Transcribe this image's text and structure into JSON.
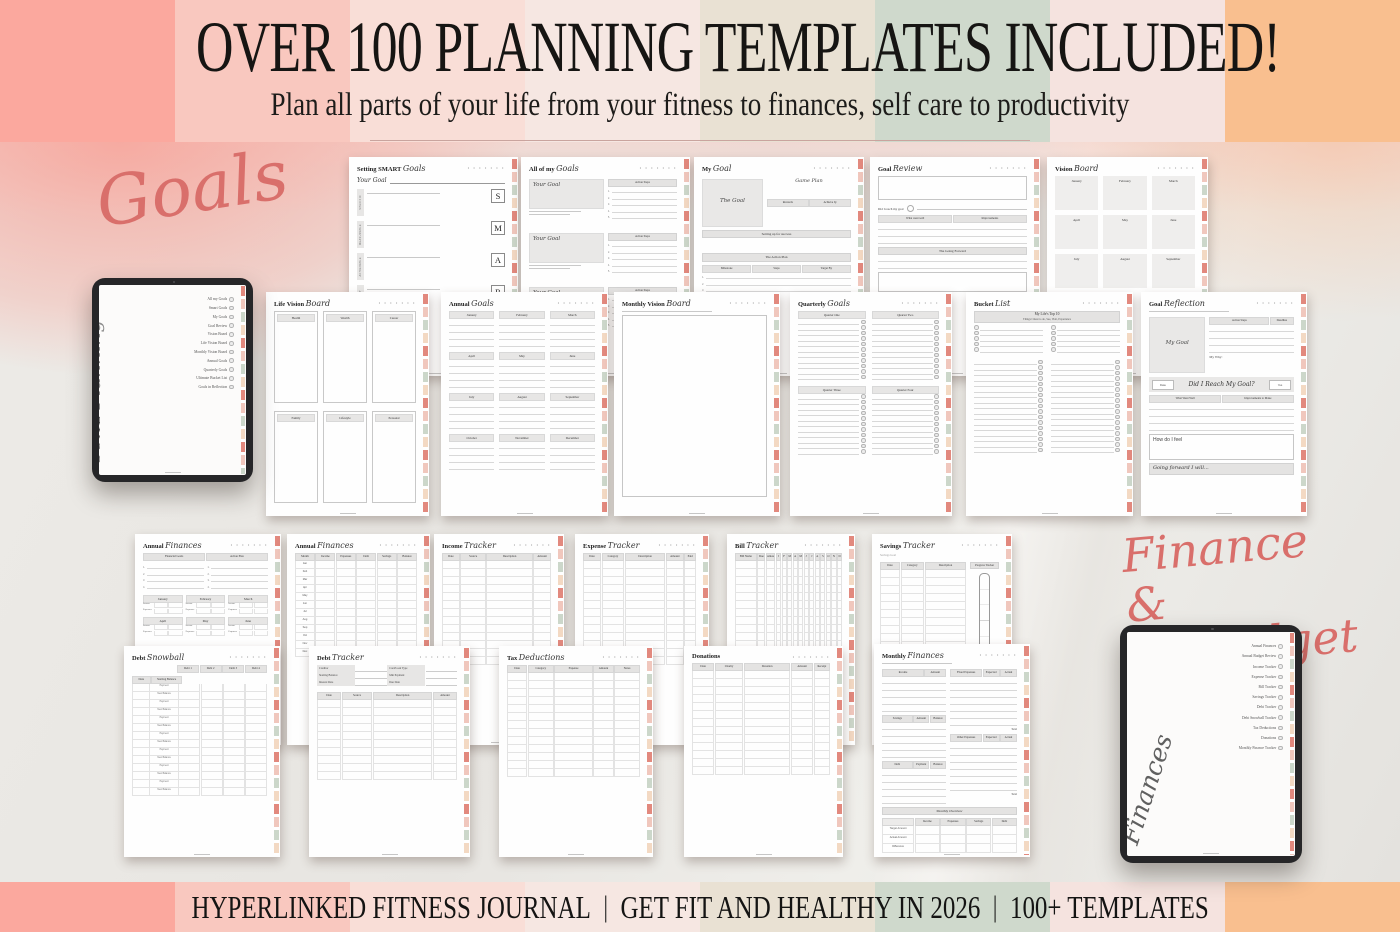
{
  "header": {
    "title": "OVER 100 PLANNING TEMPLATES INCLUDED!",
    "subtitle": "Plan all parts of your life from your fitness to finances, self care to productivity"
  },
  "footer": {
    "part1": "HYPERLINKED FITNESS JOURNAL",
    "part2": "GET FIT AND HEALTHY IN 2026",
    "part3": "100+ TEMPLATES",
    "separator": "|"
  },
  "section_labels": {
    "goals": "Goals",
    "finance_line1": "Finance &",
    "finance_line2": "Budget"
  },
  "colors": {
    "accent_script": "#d96f6b",
    "stripes": [
      "#fba89e",
      "#f9c8bf",
      "#f9ded7",
      "#f6e7e2",
      "#e9e1d3",
      "#cfd9cc",
      "#f5e3df",
      "#f9bf8f"
    ],
    "tab_colors": [
      "#e2897e",
      "#f0c7bd",
      "#ccd7ca",
      "#f3d9c3"
    ]
  },
  "page_chrome": {
    "dots": "• • • • • • •"
  },
  "tablets": {
    "left": {
      "label_serif": "GOAL",
      "label_script": "Planning",
      "items": [
        "All my Goals",
        "Smart Goals",
        "My Goals",
        "Goal Review",
        "Vision Board",
        "Life Vision Board",
        "Monthly Vision Board",
        "Annual Goals",
        "Quarterly Goals",
        "Ultimate Bucket List",
        "Goals in Reflection"
      ]
    },
    "right": {
      "label_script": "Finances",
      "items": [
        "Annual Finances",
        "Annual Budget Review",
        "Income Tracker",
        "Expense Tracker",
        "Bill Tracker",
        "Savings Tracker",
        "Debt Tracker",
        "Debt Snowball Tracker",
        "Tax Deductions",
        "Donations",
        "Monthly Finance Tracker"
      ]
    }
  },
  "pages": [
    {
      "id": "setting-smart-goals",
      "title_main": "Setting SMART",
      "title_script": "Goals",
      "body": [
        {
          "t": "field",
          "label": "Your Goal"
        },
        {
          "t": "smart",
          "rows": [
            [
              "S",
              "Specific"
            ],
            [
              "M",
              "Measurable"
            ],
            [
              "A",
              "Achievable"
            ],
            [
              "R",
              "Relevant"
            ]
          ]
        }
      ]
    },
    {
      "id": "all-of-my-goals",
      "title_main": "All of my",
      "title_script": "Goals",
      "body": [
        {
          "t": "goalblock",
          "box_label": "Your Goal",
          "steps_label": "Action Steps",
          "n": 5
        },
        {
          "t": "gap",
          "h": 8
        },
        {
          "t": "goalblock",
          "box_label": "Your Goal",
          "steps_label": "Action Steps",
          "n": 5
        },
        {
          "t": "gap",
          "h": 8
        },
        {
          "t": "goalblock",
          "box_label": "Your Goal",
          "steps_label": "Action Steps",
          "n": 5
        }
      ]
    },
    {
      "id": "my-goal",
      "title_main": "My",
      "title_script": "Goal",
      "body": [
        {
          "t": "split",
          "l": 42,
          "r": 58,
          "left": [
            {
              "t": "box",
              "h": 48,
              "mode": "fill",
              "label": "The Goal",
              "script": true
            }
          ],
          "right": [
            {
              "t": "text",
              "text": "Game Plan",
              "script": true,
              "align": "center",
              "size": 5
            },
            {
              "t": "gap",
              "h": 12
            },
            {
              "t": "cols",
              "cells": [
                {
                  "text": "Rewards"
                },
                {
                  "text": "Achieve by"
                }
              ]
            }
          ]
        },
        {
          "t": "band",
          "text": "Setting up for success"
        },
        {
          "t": "gap",
          "h": 12
        },
        {
          "t": "band",
          "text": "The Action Plan"
        },
        {
          "t": "cols",
          "cells": [
            {
              "text": "Milestone"
            },
            {
              "text": "Steps"
            },
            {
              "text": "Target By"
            }
          ]
        },
        {
          "t": "numlines",
          "n": 3
        }
      ]
    },
    {
      "id": "goal-review",
      "title_main": "Goal",
      "title_script": "Review",
      "body": [
        {
          "t": "box",
          "h": 24,
          "mode": "outline"
        },
        {
          "t": "reviewrow",
          "label": "Did I reach my goal"
        },
        {
          "t": "cols",
          "cells": [
            {
              "text": "What went well"
            },
            {
              "text": "Improvements"
            }
          ]
        },
        {
          "t": "rule",
          "n": 3
        },
        {
          "t": "band",
          "text": "The Going Forward"
        },
        {
          "t": "rule",
          "n": 2
        },
        {
          "t": "box",
          "h": 20,
          "mode": "outline"
        }
      ]
    },
    {
      "id": "vision-board",
      "title_main": "Vision",
      "title_script": "Board",
      "body": [
        {
          "t": "grid",
          "mode": "fill",
          "cols": 3,
          "cellH": 34,
          "gap": 5,
          "labels": [
            "January",
            "February",
            "March",
            "April",
            "May",
            "June",
            "July",
            "August",
            "September"
          ]
        }
      ]
    },
    {
      "id": "life-vision-board",
      "title_main": "Life Vision",
      "title_script": "Board",
      "body": [
        {
          "t": "grid",
          "mode": "outline",
          "cols": 3,
          "cellH": 92,
          "gap": 5,
          "labels": [
            "Health",
            "Wealth",
            "Career"
          ]
        },
        {
          "t": "gap",
          "h": 5
        },
        {
          "t": "grid",
          "mode": "outline",
          "cols": 3,
          "cellH": 92,
          "gap": 5,
          "labels": [
            "Family",
            "Lifestyle",
            "Personal"
          ]
        }
      ]
    },
    {
      "id": "annual-goals",
      "title_main": "Annual",
      "title_script": "Goals",
      "body": [
        {
          "t": "grid",
          "mode": "bandlines",
          "cols": 3,
          "gap": 5,
          "lines": 4,
          "labels": [
            "January",
            "February",
            "March",
            "April",
            "May",
            "June",
            "July",
            "August",
            "September",
            "October",
            "November",
            "December"
          ]
        }
      ]
    },
    {
      "id": "monthly-vision-board",
      "title_main": "Monthly Vision",
      "title_script": "Board",
      "body": [
        {
          "t": "blurb",
          "w": 62
        },
        {
          "t": "box",
          "h": 182,
          "mode": "outline"
        }
      ]
    },
    {
      "id": "quarterly-goals",
      "title_main": "Quarterly",
      "title_script": "Goals",
      "body": [
        {
          "t": "grid",
          "mode": "quarter",
          "cols": 2,
          "gap": 6,
          "lines": 11,
          "labels": [
            "Quarter One",
            "Quarter Two",
            "Quarter Three",
            "Quarter Four"
          ]
        }
      ]
    },
    {
      "id": "bucket-list",
      "title_main": "Bucket",
      "title_script": "List",
      "body": [
        {
          "t": "band2",
          "l1": "My Life's Top 10",
          "l2": "Things I must to do, See, Visit, Experience"
        },
        {
          "t": "checklist",
          "colsn": 2,
          "n": 5,
          "side": "left"
        },
        {
          "t": "gap",
          "h": 5
        },
        {
          "t": "checklist",
          "colsn": 2,
          "n": 17,
          "side": "right"
        }
      ]
    },
    {
      "id": "goal-reflection",
      "title_main": "Goal",
      "title_script": "Reflection",
      "body": [
        {
          "t": "blurb",
          "w": 55
        },
        {
          "t": "split",
          "l": 40,
          "r": 60,
          "left": [
            {
              "t": "box",
              "h": 56,
              "mode": "fill",
              "label": "My Goal",
              "script": true
            }
          ],
          "right": [
            {
              "t": "cols",
              "cells": [
                {
                  "text": "Action Steps",
                  "w": 2.6
                },
                {
                  "text": "Deadline",
                  "w": 1
                }
              ]
            },
            {
              "t": "rule",
              "n": 4
            },
            {
              "t": "text",
              "text": "My Why:",
              "size": 3.4
            }
          ]
        },
        {
          "t": "reviewband",
          "left": "Date",
          "script": "Did I Reach My Goal?",
          "right": "Yes"
        },
        {
          "t": "cols",
          "cells": [
            {
              "text": "What Went Well"
            },
            {
              "text": "Improvements to Make"
            }
          ]
        },
        {
          "t": "rule",
          "n": 4
        },
        {
          "t": "box",
          "h": 26,
          "mode": "outline",
          "label": "How do I feel",
          "labelPos": "tl"
        },
        {
          "t": "band",
          "text": "Going forward I will...",
          "script": true,
          "align": "left",
          "h": 12
        }
      ]
    },
    {
      "id": "annual-finances-overview",
      "title_main": "Annual",
      "title_script": "Finances",
      "body": [
        {
          "t": "cols",
          "cells": [
            {
              "text": "Financial Goals"
            },
            {
              "text": "Action Plan"
            }
          ]
        },
        {
          "t": "split",
          "l": 50,
          "r": 50,
          "left": [
            {
              "t": "numlines",
              "n": 4
            }
          ],
          "right": [
            {
              "t": "numlines",
              "n": 4
            }
          ]
        },
        {
          "t": "gap",
          "h": 3
        },
        {
          "t": "moneymonth",
          "months": [
            "January",
            "February",
            "March",
            "April",
            "May",
            "June"
          ],
          "rows": [
            "Income",
            "Expenses"
          ]
        }
      ]
    },
    {
      "id": "annual-finances-table",
      "title_main": "Annual",
      "title_script": "Finances",
      "body": [
        {
          "t": "table",
          "cols": [
            "Month",
            "Income",
            "Expenses",
            "Debt",
            "Savings",
            "Balance"
          ],
          "w": [
            1,
            1,
            1,
            1,
            1,
            1
          ],
          "rh": 7,
          "rowLabels": [
            "Jan",
            "Feb",
            "Mar",
            "Apr",
            "May",
            "Jun",
            "Jul",
            "Aug",
            "Sep",
            "Oct",
            "Nov",
            "Dec"
          ]
        }
      ]
    },
    {
      "id": "income-tracker",
      "title_main": "Income",
      "title_script": "Tracker",
      "body": [
        {
          "t": "table",
          "cols": [
            "Date",
            "Source",
            "Description",
            "Amount"
          ],
          "w": [
            1,
            1.5,
            2.8,
            1
          ],
          "n": 13,
          "rh": 7
        }
      ]
    },
    {
      "id": "expense-tracker",
      "title_main": "Expense",
      "title_script": "Tracker",
      "body": [
        {
          "t": "table",
          "cols": [
            "Date",
            "Category",
            "Description",
            "Amount",
            "Paid"
          ],
          "w": [
            1,
            1.3,
            2.4,
            1,
            0.6
          ],
          "n": 13,
          "rh": 7
        }
      ]
    },
    {
      "id": "bill-tracker",
      "title_main": "Bill",
      "title_script": "Tracker",
      "body": [
        {
          "t": "table",
          "cols": [
            "Bill Name",
            "Due",
            "Amount",
            "J",
            "F",
            "M",
            "A",
            "M",
            "J",
            "J",
            "A",
            "S",
            "O",
            "N",
            "D"
          ],
          "w": [
            2.6,
            0.8,
            1,
            0.4,
            0.4,
            0.4,
            0.4,
            0.4,
            0.4,
            0.4,
            0.4,
            0.4,
            0.4,
            0.4,
            0.4
          ],
          "n": 13,
          "rh": 7
        }
      ]
    },
    {
      "id": "savings-tracker",
      "title_main": "Savings",
      "title_script": "Tracker",
      "body": [
        {
          "t": "text",
          "text": "Savings Goal",
          "size": 3,
          "color": "#999999"
        },
        {
          "t": "split",
          "l": 75,
          "r": 25,
          "left": [
            {
              "t": "table",
              "cols": [
                "Date",
                "Category",
                "Description"
              ],
              "w": [
                1,
                1.2,
                2.2
              ],
              "n": 11,
              "rh": 7
            }
          ],
          "right": [
            {
              "t": "band",
              "text": "Progress Tracker",
              "small": true
            },
            {
              "t": "thermo"
            }
          ]
        }
      ]
    },
    {
      "id": "debt-snowball",
      "title_main": "Debt",
      "title_script": "Snowball",
      "body": [
        {
          "t": "snowball",
          "debts": [
            "Debt 1",
            "Debt 2",
            "Debt 3",
            "Debt 4"
          ],
          "date": "Date",
          "balance": "Starting Balance",
          "alt": [
            "Payment",
            "New Balance"
          ],
          "n": 14
        }
      ]
    },
    {
      "id": "debt-tracker",
      "title_main": "Debt",
      "title_script": "Tracker",
      "body": [
        {
          "t": "fields",
          "pairs": [
            [
              "Creditor",
              "Card/Loan Type"
            ],
            [
              "Starting Balance",
              "Min Payment"
            ],
            [
              "Interest Rate",
              "Due Date"
            ]
          ]
        },
        {
          "t": "gap",
          "h": 3
        },
        {
          "t": "table",
          "cols": [
            "Date",
            "Source",
            "Description",
            "Amount"
          ],
          "w": [
            1,
            1.3,
            2.6,
            1
          ],
          "n": 10,
          "rh": 7
        }
      ]
    },
    {
      "id": "tax-deductions",
      "title_main": "Tax",
      "title_script": "Deductions",
      "body": [
        {
          "t": "table",
          "cols": [
            "Date",
            "Category",
            "Expense",
            "Amount",
            "Notes"
          ],
          "w": [
            1,
            1.3,
            2,
            1,
            1.3
          ],
          "n": 13,
          "rh": 7
        }
      ]
    },
    {
      "id": "donations",
      "title_main": "Donations",
      "title_script": "",
      "body": [
        {
          "t": "table",
          "cols": [
            "Date",
            "Charity",
            "Donation",
            "Amount",
            "Receipt"
          ],
          "w": [
            1,
            1.3,
            2.2,
            1,
            0.7
          ],
          "n": 13,
          "rh": 7
        }
      ]
    },
    {
      "id": "monthly-finances",
      "title_main": "Monthly",
      "title_script": "Finances",
      "body": [
        {
          "t": "blurb",
          "w": 52
        },
        {
          "t": "split",
          "l": 49,
          "r": 51,
          "left": [
            {
              "t": "cols",
              "cells": [
                {
                  "text": "Income",
                  "w": 2
                },
                {
                  "text": "Amount",
                  "w": 1
                }
              ]
            },
            {
              "t": "rule",
              "n": 5
            },
            {
              "t": "cols",
              "cells": [
                {
                  "text": "Savings",
                  "w": 2
                },
                {
                  "text": "Amount",
                  "w": 1
                },
                {
                  "text": "Balance",
                  "w": 1
                }
              ]
            },
            {
              "t": "rule",
              "n": 5
            },
            {
              "t": "cols",
              "cells": [
                {
                  "text": "Debt",
                  "w": 2
                },
                {
                  "text": "Payment",
                  "w": 1
                },
                {
                  "text": "Balance",
                  "w": 1
                }
              ]
            },
            {
              "t": "rule",
              "n": 5
            }
          ],
          "right": [
            {
              "t": "cols",
              "cells": [
                {
                  "text": "Fixed Expenses",
                  "w": 2
                },
                {
                  "text": "Expected",
                  "w": 1
                },
                {
                  "text": "Actual",
                  "w": 1
                }
              ]
            },
            {
              "t": "rule",
              "n": 7
            },
            {
              "t": "text",
              "text": "Total",
              "size": 2.8,
              "align": "right"
            },
            {
              "t": "cols",
              "cells": [
                {
                  "text": "Other Expenses",
                  "w": 2
                },
                {
                  "text": "Expected",
                  "w": 1
                },
                {
                  "text": "Actual",
                  "w": 1
                }
              ]
            },
            {
              "t": "rule",
              "n": 7
            },
            {
              "t": "text",
              "text": "Total",
              "size": 2.8,
              "align": "right"
            }
          ]
        },
        {
          "t": "band",
          "text": "Monthly Overview"
        },
        {
          "t": "table",
          "cols": [
            "",
            "Income",
            "Expenses",
            "Savings",
            "Debt"
          ],
          "w": [
            1.3,
            1,
            1,
            1,
            1
          ],
          "rh": 8,
          "rowLabels": [
            "Target Amount",
            "Actual Amount",
            "Difference"
          ]
        }
      ]
    }
  ]
}
